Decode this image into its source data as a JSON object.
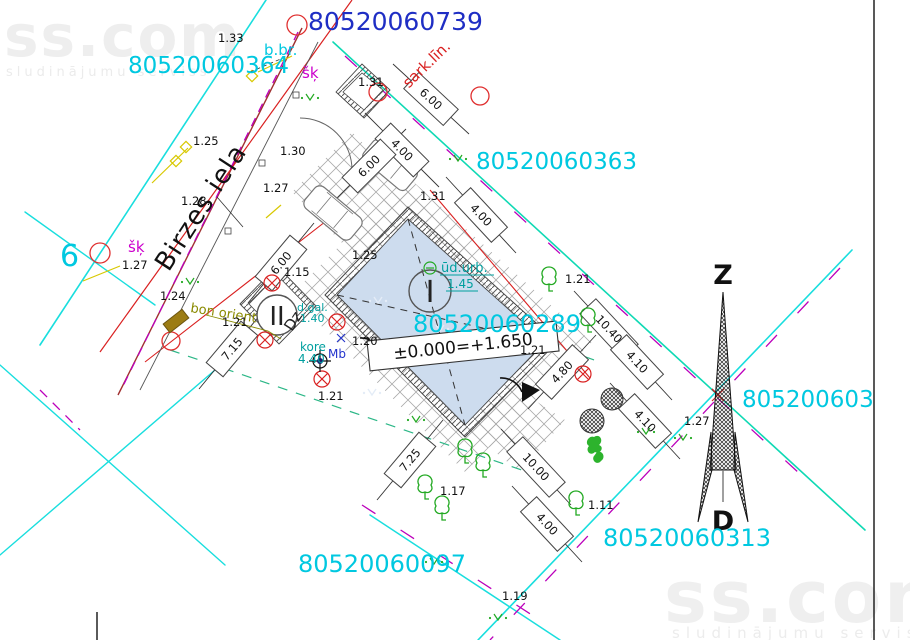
{
  "watermark": {
    "brand": "ss.com",
    "tagline": "sludinājumu serviss"
  },
  "parcel_numbers": {
    "top": "80520060739",
    "left": "80520060364",
    "right_top": "80520060363",
    "center": "80520060289",
    "bottom_right": "80520060313",
    "bottom": "80520060097",
    "right_edge": "805200603",
    "left_partial": "6"
  },
  "street_name": "Birzes iela",
  "compass": {
    "north": "Z",
    "south": "D"
  },
  "annotations": {
    "red_line": "sark.līn.",
    "b_br": "b.br.",
    "shk_top": "šķ",
    "shk_left": "šķ",
    "orient": "bon orient",
    "dz": "Dz",
    "building1": "I",
    "building2": "II",
    "water_borehole": "ūd.urb.",
    "water_borehole_elev": "1.45",
    "ridge_label": "kore",
    "ridge_value": "4.40",
    "material": "Mb",
    "dgal_label": "d.gal.",
    "dgal_value": "1.40",
    "elevation_mark": "±0.000=+1.650"
  },
  "dimensions": [
    "6.00",
    "4.00",
    "6.00",
    "4.00",
    "6.00",
    "7.15",
    "7.25",
    "10.00",
    "4.00",
    "10.40",
    "4.10",
    "4.80",
    "4.10"
  ],
  "spot_elevations": [
    "1.33",
    "1.31",
    "1.25",
    "1.30",
    "1.27",
    "1.28.",
    "1.27",
    "1.24",
    "1.21",
    "1.15",
    "1.25",
    "1.31",
    "1.21",
    "1.20",
    "1.21",
    "1.21",
    "1.17",
    "1.11",
    "1.27",
    "1.19"
  ],
  "colors": {
    "parcel_cyan": "#00c8e0",
    "parcel_blue": "#1f2ec4",
    "boundary_cyan": "#19dede",
    "boundary_teal": "#0fd9b4",
    "red": "#d92020",
    "street_red": "#a03030",
    "magenta": "#bb00bb",
    "green": "#22a922",
    "teal_text": "#009f9f",
    "olive": "#8a8a00"
  }
}
